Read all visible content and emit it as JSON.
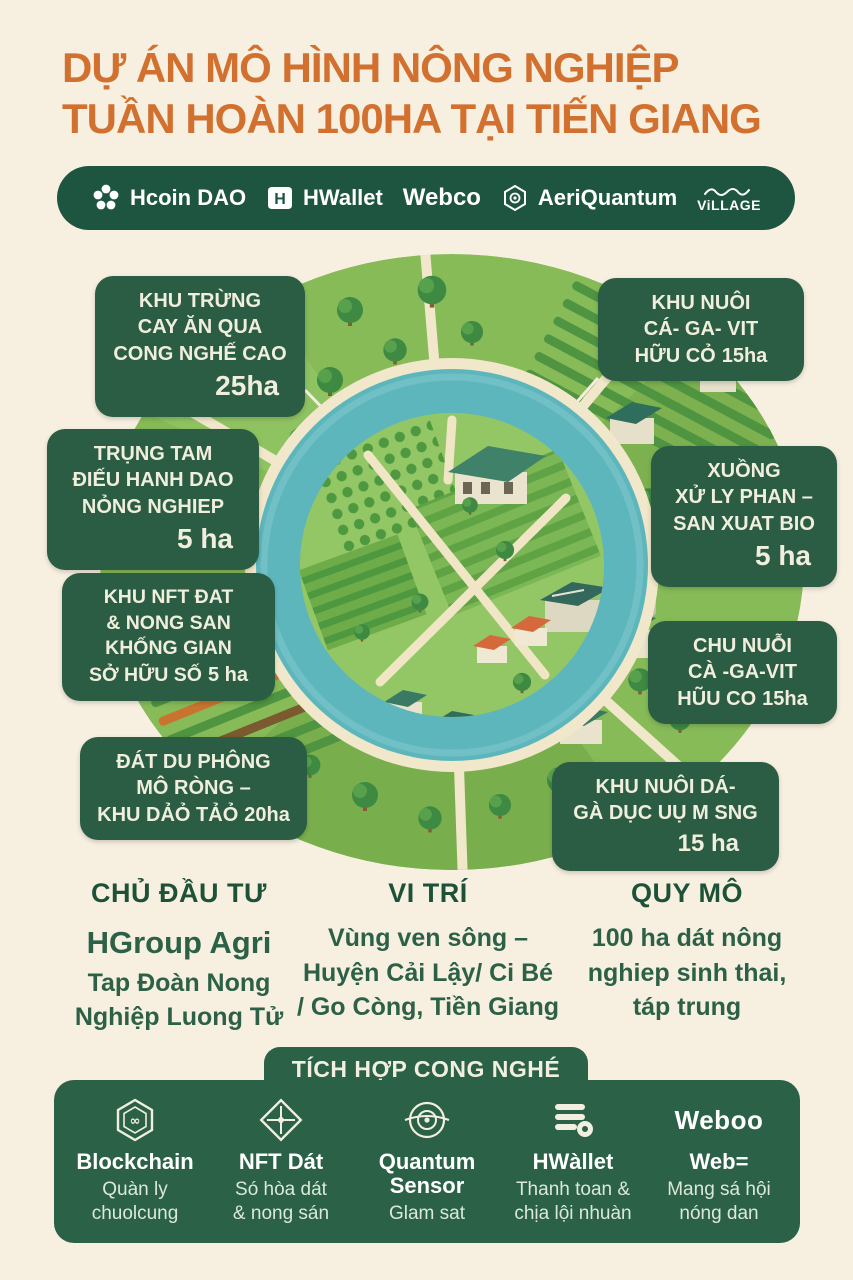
{
  "title": {
    "line1": "DỰ ÁN MÔ HÌNH NÔNG NGHIỆP",
    "line2": "TUẦN HOÀN 100HA TẠI TIẾN GIANG"
  },
  "partners": [
    {
      "name": "Hcoin DAO",
      "icon": "flower-icon"
    },
    {
      "name": "HWallet",
      "icon": "shield-h-icon"
    },
    {
      "name": "Webco",
      "icon": "wordmark"
    },
    {
      "name": "AeriQuantum",
      "icon": "hexagon-shield-icon"
    },
    {
      "name": "ViLLAGE",
      "icon": "script-squiggle-icon"
    }
  ],
  "zones": [
    {
      "lines": [
        "KHU TRỪNG",
        "CAY ĂN QUA",
        "CONG NGHẾ CAO"
      ],
      "area": "25ha"
    },
    {
      "lines": [
        "KHU NUÔI",
        "CÁ- GA- VIT",
        "HỮU CỎ"
      ],
      "area": "15ha"
    },
    {
      "lines": [
        "TRỤNG TAM",
        "ĐIẾU HANH DAO",
        "NỎNG NGHIEP"
      ],
      "area": "5 ha"
    },
    {
      "lines": [
        "XUỒNG",
        "XỬ LY PHAN –",
        "SAN XUAT BIO"
      ],
      "area": "5 ha"
    },
    {
      "lines": [
        "KHU NFT ĐAT",
        "& NONG SAN",
        "KHỐNG GIAN",
        "SỞ HỮU SỐ"
      ],
      "area": "5 ha"
    },
    {
      "lines": [
        "CHU NUỖI",
        "CÀ -GA-VIT",
        "HŨU CO"
      ],
      "area": "15ha"
    },
    {
      "lines": [
        "ĐÁT DU PHÔNG",
        "MÔ RÒNG –",
        "KHU DẢỎ TẢỎ"
      ],
      "area": "20ha"
    },
    {
      "lines": [
        "KHU NUÔI DÁ-",
        "GÀ DỤC UỤ M SNG"
      ],
      "area": "15 ha"
    }
  ],
  "info_columns": [
    {
      "title": "CHỦ ĐẦU TƯ",
      "lines": [
        "HGroup Agri",
        "Tap Đoàn Nong",
        "Nghiệp Luong Tử"
      ]
    },
    {
      "title": "VI TRÍ",
      "lines": [
        "Vùng ven sông –",
        "Huyện Cải Lậy/ Ci Bé",
        "/ Go Còng, Tiền Giang"
      ]
    },
    {
      "title": "QUY MÔ",
      "lines": [
        "100 ha dát nông",
        "nghiep sinh thai,",
        "táp trung"
      ]
    }
  ],
  "tech_panel": {
    "title": "TÍCH HỢP CONG NGHÉ",
    "items": [
      {
        "icon": "blockchain-hexagon-icon",
        "name": "Blockchain",
        "desc1": "Quàn ly",
        "desc2": "chuolcung"
      },
      {
        "icon": "nft-diamond-icon",
        "name": "NFT Dát",
        "desc1": "Só hòa dát",
        "desc2": "& nong sán"
      },
      {
        "icon": "quantum-sensor-icon",
        "name": "Quantum Sensor",
        "desc1": "Glam sat",
        "desc2": ""
      },
      {
        "icon": "wallet-stack-icon",
        "name": "HWàllet",
        "desc1": "Thanh toan &",
        "desc2": "chịa lội nhuàn"
      },
      {
        "icon": "weboo-wordmark",
        "logo": "Weboo",
        "name": "Web=",
        "desc1": "Mang sá hội",
        "desc2": "nóng dan"
      }
    ]
  },
  "colors": {
    "background": "#F7EFE0",
    "title_orange": "#D2712F",
    "label_green": "#2B5C44",
    "bar_green": "#1E5540",
    "panel_green": "#2A6147",
    "water_teal": "#5EB6BD",
    "grass_light": "#86BB58",
    "grass_island": "#93C765"
  }
}
